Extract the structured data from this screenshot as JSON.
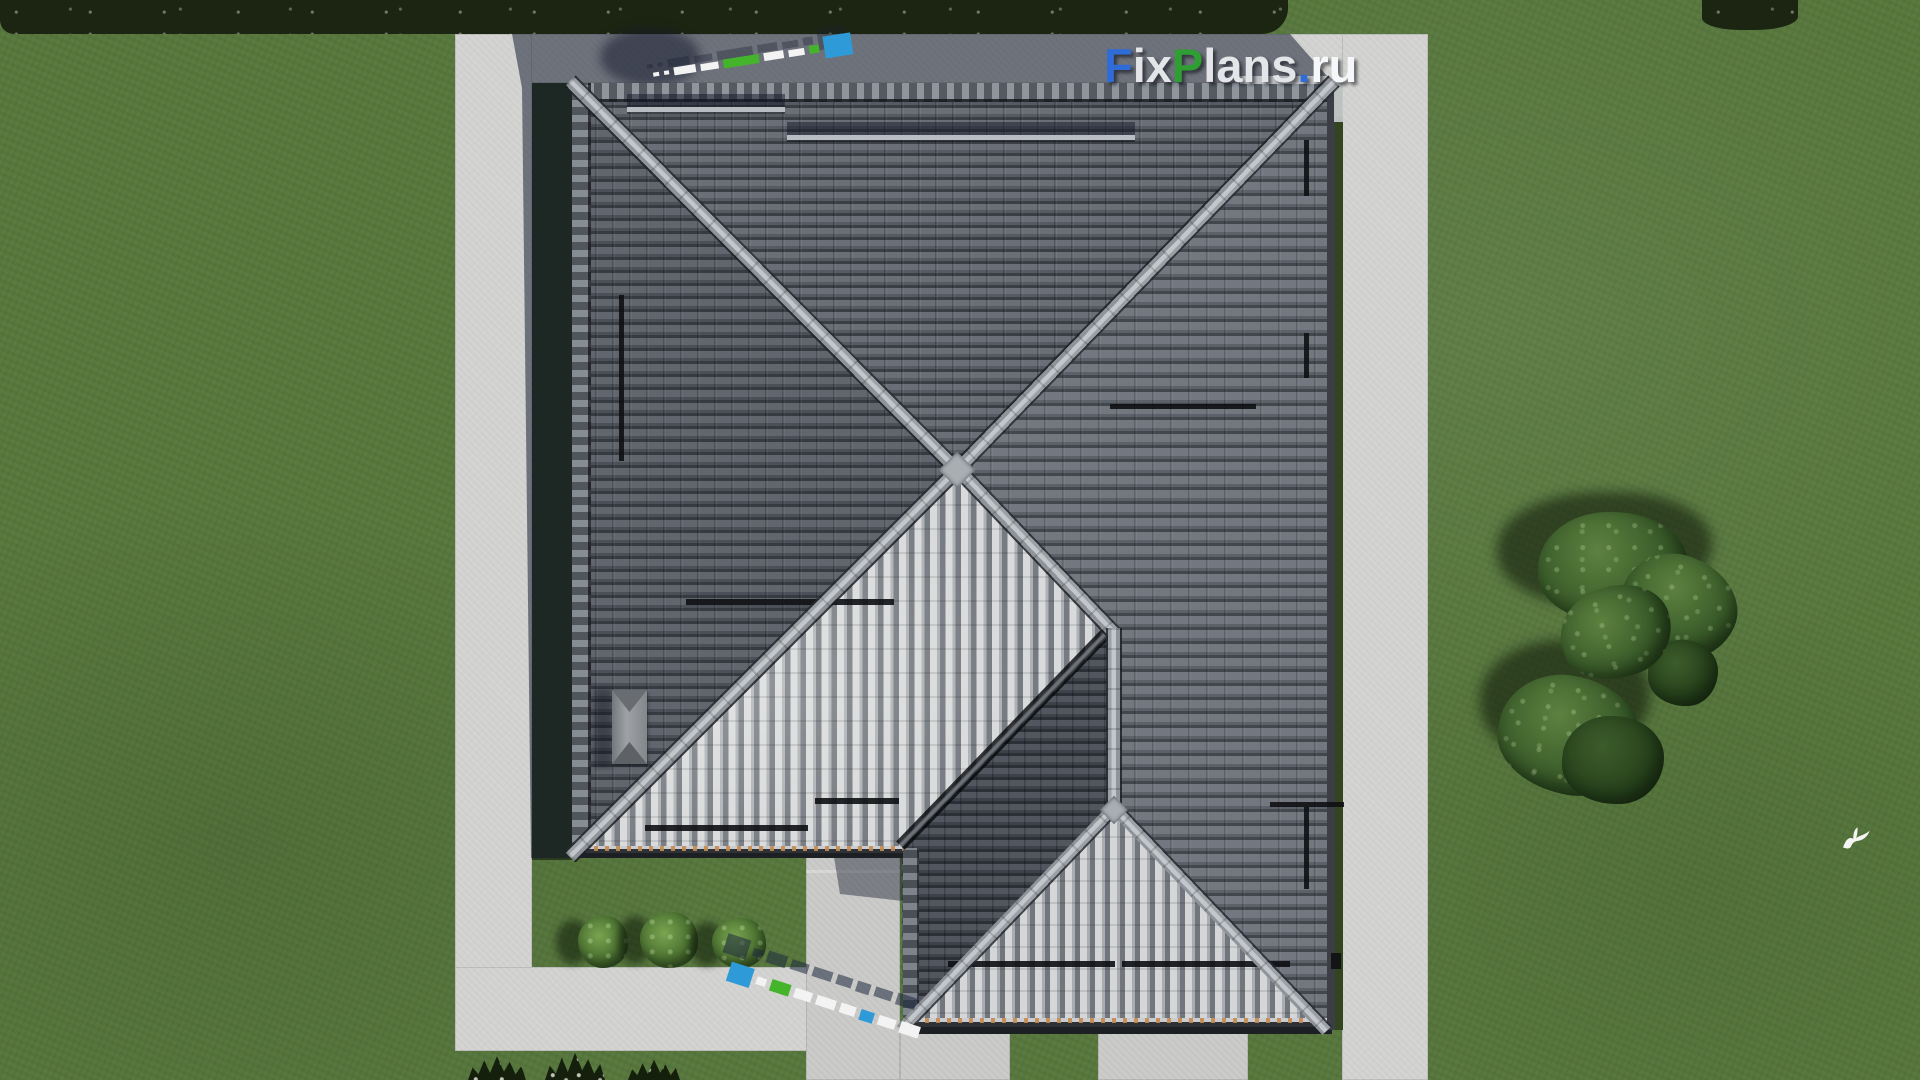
{
  "brand": {
    "logo_text": "FixPlans.ru",
    "logo_parts": [
      {
        "text": "F",
        "color": "#2f6cd8"
      },
      {
        "text": "ix",
        "color": "#e3e5e8"
      },
      {
        "text": "P",
        "color": "#2f9e33"
      },
      {
        "text": "lans",
        "color": "#e3e5e8"
      },
      {
        "text": ".",
        "color": "#2f6cd8"
      },
      {
        "text": "ru",
        "color": "#f6f7f8"
      }
    ]
  },
  "scene": {
    "description": "Aerial top-down 3D render of a house with a grey tiled hip roof, concrete paths around it, lawn, bushes and trees",
    "bush_count": 3,
    "tree_clusters": 2,
    "birds": 1
  },
  "palette": {
    "lawn": "#5a7a40",
    "lawn_shade": "#1b2511",
    "path": "#d3d3d1",
    "shadow_tint": "rgba(18,24,44,0.52)",
    "roof_north": "#63676f",
    "roof_east": "#6f737b",
    "roof_west": "#5d6169",
    "roof_bright": "#d6d7d8",
    "roof_wing": "#4a4e55",
    "ridge_cap": "#b6babf",
    "eave_clay": "#c08850",
    "watermark_blue": "#2e9ad8",
    "watermark_green": "#44b42a",
    "watermark_white": "#f2f3f2"
  }
}
